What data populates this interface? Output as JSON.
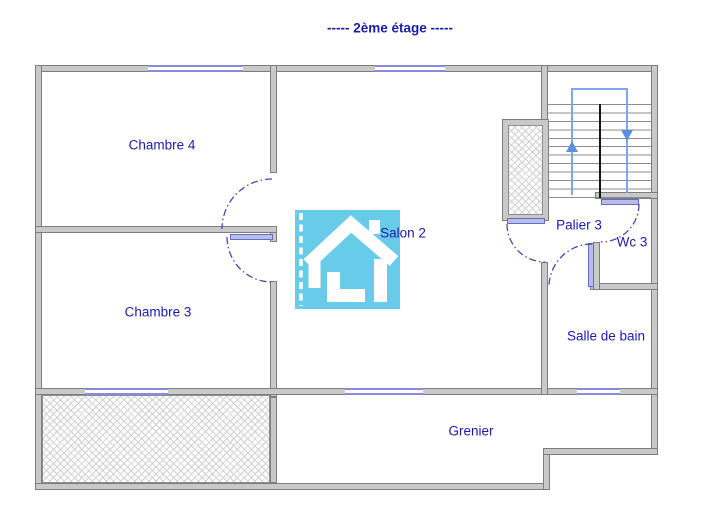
{
  "title": "-----  2ème étage  -----",
  "rooms": [
    {
      "id": "chambre4",
      "label": "Chambre 4"
    },
    {
      "id": "salon2",
      "label": "Salon 2"
    },
    {
      "id": "chambre3",
      "label": "Chambre 3"
    },
    {
      "id": "palier3",
      "label": "Palier 3"
    },
    {
      "id": "wc3",
      "label": "Wc 3"
    },
    {
      "id": "salle_de_bain",
      "label": "Salle de bain"
    },
    {
      "id": "grenier",
      "label": "Grenier"
    }
  ],
  "stairs": {
    "up_arrow_icon": "up-direction",
    "down_arrow_icon": "down-direction"
  },
  "colors": {
    "label_text": "#1c1cab",
    "wall_fill": "#c9c9c9",
    "wall_edge": "#7d7d7d",
    "window_blue": "#8a8ad8",
    "door_leaf_blue": "#b9bdea",
    "door_arc_navy": "#4747ad",
    "stair_guide_blue": "#7fa8ea",
    "logo_blue": "#68cbea"
  }
}
